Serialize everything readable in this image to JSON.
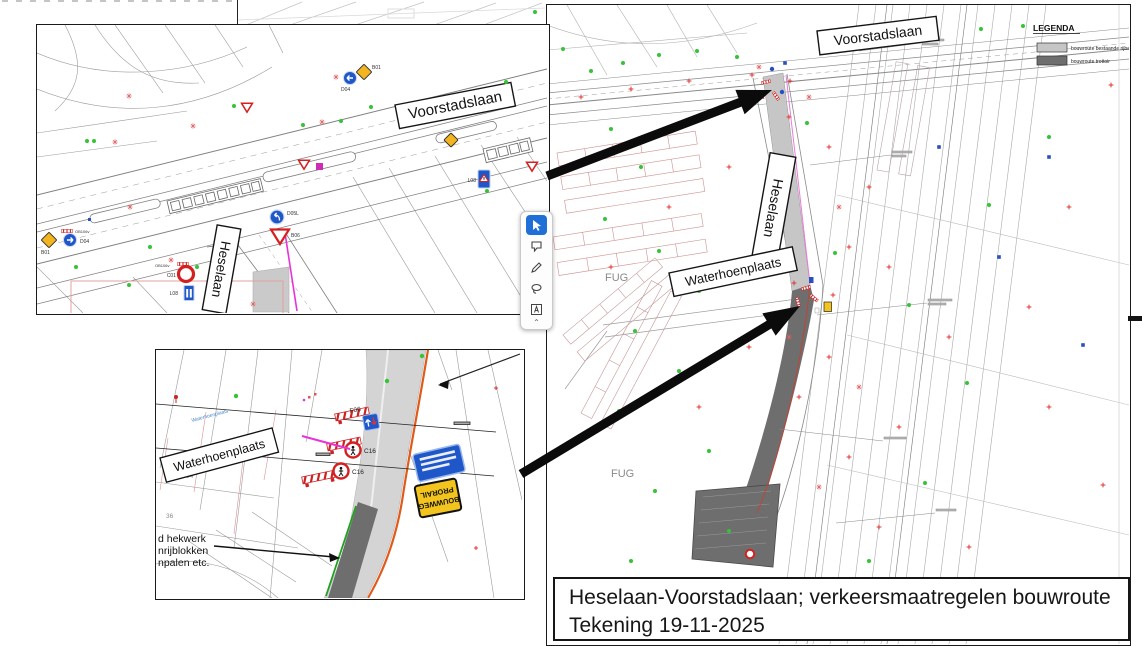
{
  "title_block": {
    "line1": "Heselaan-Voorstadslaan; verkeersmaatregelen bouwroute",
    "line2": "Tekening 19-11-2025"
  },
  "legend": {
    "title": "LEGENDA",
    "items": [
      {
        "label": "bouwroute bestaande rijbaan",
        "color": "#c6c6c6"
      },
      {
        "label": "bouwroute trottoir",
        "color": "#6e6e6e"
      }
    ]
  },
  "main_map": {
    "street_labels": {
      "voorstadslaan": "Voorstadslaan",
      "heselaan": "Heselaan",
      "waterhoenplaats": "Waterhoenplaats"
    },
    "area_labels": {
      "fug_north": "FUG",
      "fug_south": "FUG"
    }
  },
  "inset_overview": {
    "street_labels": {
      "voorstadslaan": "Voorstadslaan",
      "heselaan": "Heselaan"
    },
    "sign_labels": {
      "b01_top": "B01",
      "d04_top": "D04",
      "b01_left": "B01",
      "d04_left": "D04",
      "ob106_left": "OB106v",
      "d05l": "D05L",
      "b06": "B06",
      "c01": "C01",
      "ob106_mid": "OB106v",
      "l08_mid": "L08",
      "l08_right": "L08"
    }
  },
  "inset_detail": {
    "street_label": "Waterhoenplaats",
    "street_small": "Waterhoenplaats",
    "sign_labels": {
      "f06": "F06",
      "c16_a": "C16",
      "c16_b": "C16"
    },
    "yellow_sign": {
      "line1": "BOUWWEG",
      "line2": "PRORAIL"
    },
    "note_lines": [
      "d hekwerk",
      "nrijblokken",
      "npalen etc."
    ],
    "parcel_numbers": {
      "a": "34",
      "b": "36"
    }
  },
  "annotation_toolbar": {
    "tools": [
      {
        "name": "select"
      },
      {
        "name": "comment"
      },
      {
        "name": "draw"
      },
      {
        "name": "lasso"
      },
      {
        "name": "text"
      }
    ]
  },
  "colors": {
    "route_light": "#c6c6c6",
    "route_dark": "#6e6e6e",
    "arrow": "#0b0b0b",
    "magenta": "#e832d8",
    "orange_line": "#e05a1a",
    "green_line": "#1fa11f",
    "sign_blue": "#1f57c8",
    "sign_yellow": "#f2c41d",
    "sign_red": "#d42020"
  }
}
